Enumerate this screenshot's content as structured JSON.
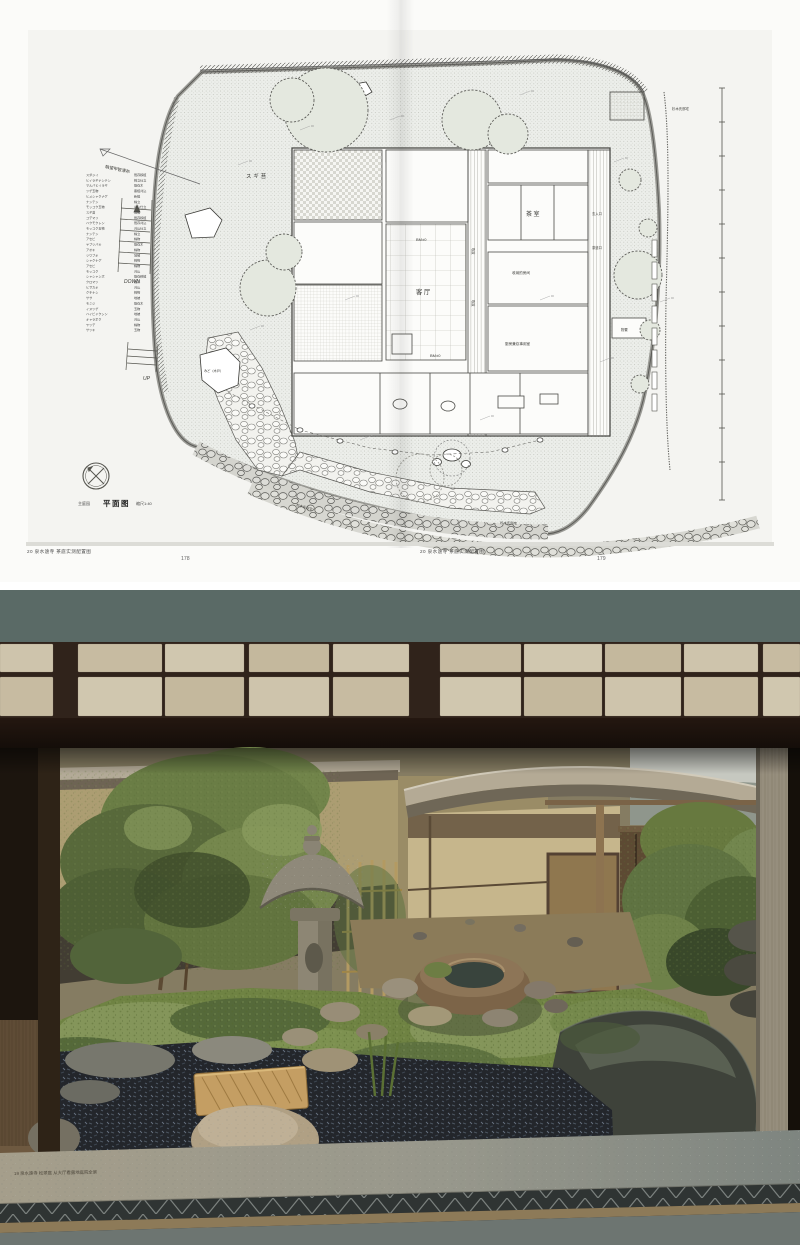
{
  "book": {
    "left_page": {
      "footer": "20 泉水遠寺 茶庭实测配置图",
      "page_number": "178"
    },
    "right_page": {
      "footer": "20 泉水遠寺 茶庭实测配置图",
      "page_number": "179"
    },
    "plan": {
      "title_prefix": "主庭园",
      "title": "平面图",
      "scale": "缩尺1:40",
      "labels": {
        "view_note": "眺望甲智漂布",
        "moss_area": "スギ苔",
        "down": "DOWN",
        "up": "UP",
        "gate": "みど（木戸）",
        "tea_room": "茶室",
        "main_hall": "客厅",
        "bm": "BM±0",
        "void": "吹抜",
        "storage_room": "收纳的房间",
        "kitchen": "厨房兼炊事用室",
        "entrance": "玄入口",
        "tea_door": "茶道口",
        "shed": "物置",
        "neighbor_top": "杉木氏邸宅",
        "neighbor_bottom": "杉木氏邸宅",
        "spot": "±0"
      },
      "legend": {
        "rows": [
          "スダジイ 既存移植",
          "ヒイラギナンテン 株立仕立",
          "マルバヒイラギ 既存木",
          "ツゲ玉物 寄植刈込",
          "ヒメシャクナゲ 新植",
          "ナンテン 株立",
          "モッコク玉物 刈込仕立",
          "スギ苔 地被",
          "コデマリ 既存移植",
          "ハクモクレン 既存刈込",
          "モッコク玉物 刈込仕立",
          "ナンテン 株立",
          "アセビ 株物",
          "ヤブツバキ 既存木",
          "アオキ 株物",
          "ツワブキ 地被",
          "シャクナゲ 株物",
          "アセビ 株物",
          "モッコク 刈込",
          "シャシャンボ 既存移植",
          "クロマツ 既存",
          "ヒサカキ 刈込",
          "クチナシ 株物",
          "ササ 地被",
          "モミジ 既存木",
          "イヌツゲ 玉物",
          "ハイビャクシン 地被",
          "キャラボク 刈込",
          "ヤツデ 株物",
          "サツキ 玉物"
        ]
      }
    }
  },
  "photo": {
    "caption": "19 泉水遠寺 松翠庭 从大厅看露地庭院全景",
    "shoji": {
      "rows": 2,
      "columns": 10
    },
    "colors": {
      "top_band": "#5a6a66",
      "shoji_frame": "#281b12",
      "shoji_pane": "#c8bca2",
      "moss": "#6f8343",
      "pebbles": "#23262b",
      "stucco_wall": "#ac9d72",
      "teahouse_wall": "#c6b68c",
      "lantern_stone": "#8d8674",
      "ledge": "#a09a86",
      "bottom_band": "#6d7571"
    }
  }
}
